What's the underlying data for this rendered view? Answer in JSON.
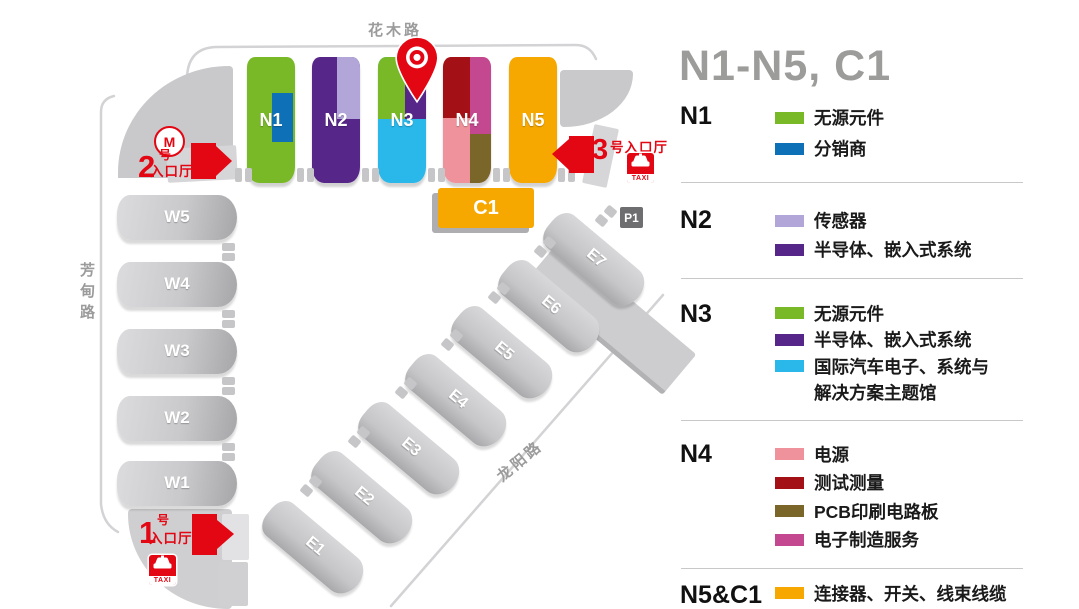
{
  "title": "N1-N5, C1",
  "colors": {
    "green": "#79b928",
    "blue": "#0e71b8",
    "lightpurple": "#b2a5d7",
    "darkpurple": "#562688",
    "cyan": "#2ab7ea",
    "pink": "#ef929b",
    "darkred": "#a31116",
    "brown": "#7b662a",
    "magenta": "#c3488f",
    "orange": "#f6a800",
    "red": "#e30613"
  },
  "map": {
    "roads": {
      "top": "花木路",
      "left": "芳甸路",
      "diagonal": "龙阳路"
    },
    "north_halls": [
      "N1",
      "N2",
      "N3",
      "N4",
      "N5"
    ],
    "west_halls": [
      "W5",
      "W4",
      "W3",
      "W2",
      "W1"
    ],
    "east_halls": [
      "E1",
      "E2",
      "E3",
      "E4",
      "E5",
      "E6",
      "E7"
    ],
    "c1_label": "C1",
    "parking_label": "P1",
    "taxi_label": "TAXI",
    "metro_label": "M",
    "entrances": [
      {
        "number": "2",
        "suffix": "号",
        "hall": "入口厅"
      },
      {
        "number": "3",
        "suffix": "号入口厅",
        "hall": ""
      },
      {
        "number": "1",
        "suffix": "号",
        "hall": "入口厅"
      }
    ]
  },
  "legend": {
    "sections": [
      {
        "hall": "N1",
        "items": [
          {
            "color": "green",
            "label": "无源元件"
          },
          {
            "color": "blue",
            "label": "分销商"
          }
        ]
      },
      {
        "hall": "N2",
        "items": [
          {
            "color": "lightpurple",
            "label": "传感器"
          },
          {
            "color": "darkpurple",
            "label": "半导体、嵌入式系统"
          }
        ]
      },
      {
        "hall": "N3",
        "items": [
          {
            "color": "green",
            "label": "无源元件"
          },
          {
            "color": "darkpurple",
            "label": "半导体、嵌入式系统"
          },
          {
            "color": "cyan",
            "label": "国际汽车电子、系统与",
            "label2": "解决方案主题馆"
          }
        ]
      },
      {
        "hall": "N4",
        "items": [
          {
            "color": "pink",
            "label": "电源"
          },
          {
            "color": "darkred",
            "label": "测试测量"
          },
          {
            "color": "brown",
            "label": "PCB印刷电路板"
          },
          {
            "color": "magenta",
            "label": "电子制造服务"
          }
        ]
      },
      {
        "hall": "N5&C1",
        "items": [
          {
            "color": "orange",
            "label": "连接器、开关、线束线缆"
          }
        ]
      }
    ]
  }
}
